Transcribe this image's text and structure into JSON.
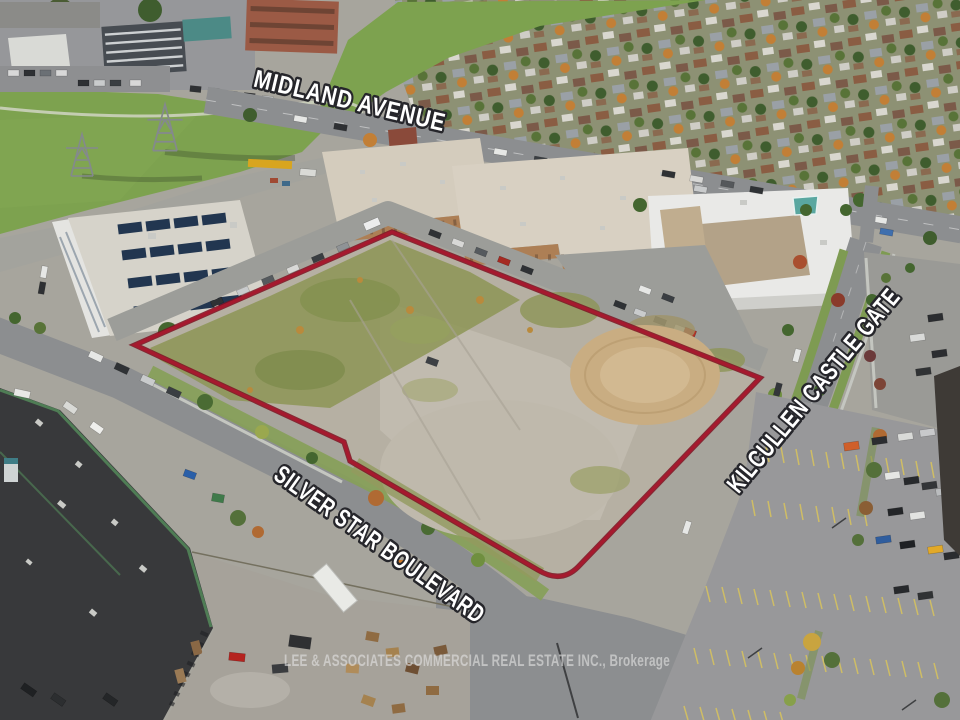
{
  "image_type": "aerial-drone-photograph-listing",
  "street_labels": [
    {
      "id": "midland-avenue",
      "text": "MIDLAND AVENUE"
    },
    {
      "id": "silver-star-boulevard",
      "text": "SILVER STAR BOULEVARD"
    },
    {
      "id": "kilcullen-castle-gate",
      "text": "KILCULLEN CASTLE GATE"
    }
  ],
  "watermark": {
    "text": "LEE & ASSOCIATES COMMERCIAL REAL ESTATE INC., Brokerage"
  },
  "property": {
    "outline_color": "#a6192e"
  },
  "colors": {
    "property_outline": "#a6192e",
    "label_fill": "#ffffff",
    "label_outline": "#26262b",
    "watermark_text": "#e2e2e2"
  }
}
